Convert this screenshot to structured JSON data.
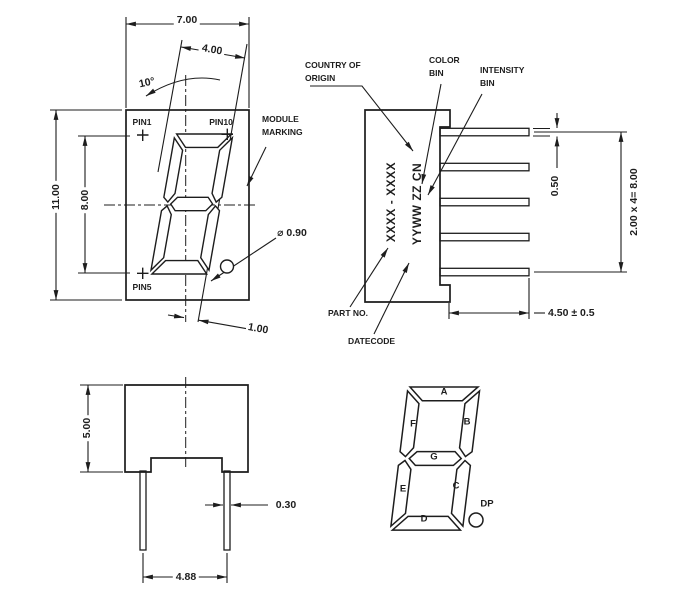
{
  "front_view": {
    "width_dim": "7.00",
    "digit_width_dim": "4.00",
    "tilt_angle": "10°",
    "height_dim": "11.00",
    "pin_row_dim": "8.00",
    "dp_offset_dim": "1.00",
    "dp_diameter_dim": "⌀ 0.90",
    "pin1_label": "PIN1",
    "pin10_label": "PIN10",
    "pin5_label": "PIN5",
    "module_marking_line1": "MODULE",
    "module_marking_line2": "MARKING"
  },
  "side_view": {
    "marking_line1": "XXXX - XXXX",
    "marking_line2": "YYWW ZZ CN",
    "country_line1": "COUNTRY OF",
    "country_line2": "ORIGIN",
    "color_line1": "COLOR",
    "color_line2": "BIN",
    "intensity_line1": "INTENSITY",
    "intensity_line2": "BIN",
    "part_no_label": "PART NO.",
    "datecode_label": "DATECODE",
    "pin_thickness_dim": "0.50",
    "pin_pitch_dim": "2.00 x 4= 8.00",
    "pin_length_dim": "4.50 ± 0.5"
  },
  "bottom_view": {
    "depth_dim": "5.00",
    "pin_width_dim": "0.30",
    "pin_spacing_dim": "4.88"
  },
  "segment_diagram": {
    "seg_a": "A",
    "seg_b": "B",
    "seg_c": "C",
    "seg_d": "D",
    "seg_e": "E",
    "seg_f": "F",
    "seg_g": "G",
    "dp_label": "DP"
  },
  "colors": {
    "ink": "#1d1d1d",
    "background": "#ffffff"
  }
}
